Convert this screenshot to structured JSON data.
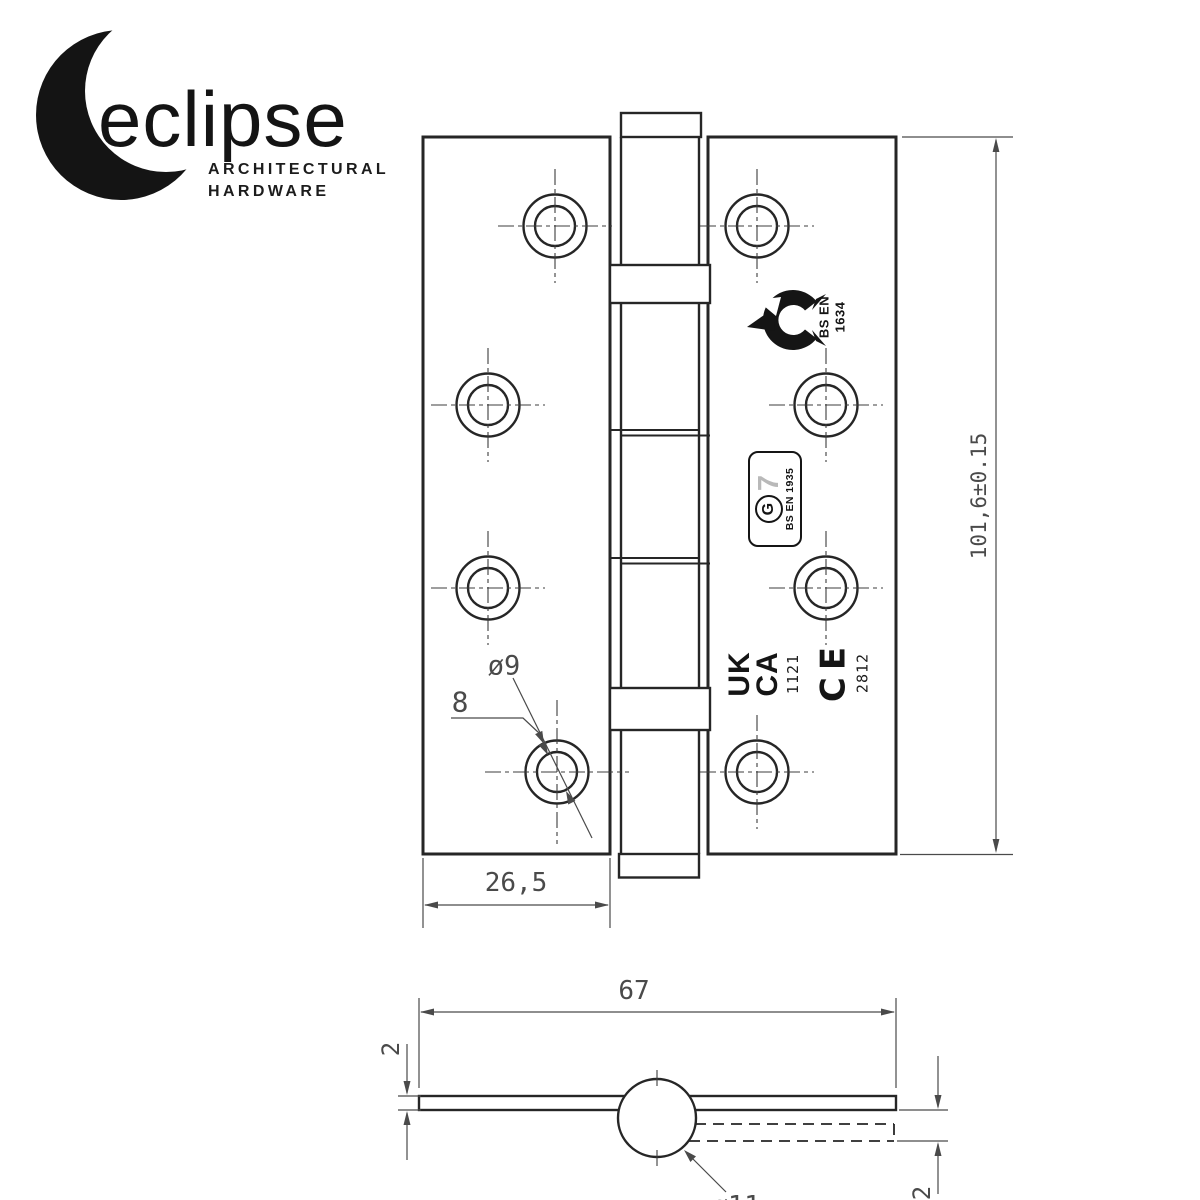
{
  "brand": {
    "name": "eclipse",
    "tagline_line1": "ARCHITECTURAL",
    "tagline_line2": "HARDWARE"
  },
  "dimensions": {
    "plate_height": "101,6±0.15",
    "leaf_width": "26,5",
    "open_width": "67",
    "screw_hole_diameter": "ø9",
    "countersink_ref": "8",
    "knuckle_diameter": "ø11",
    "leaf_thickness_left": "2",
    "leaf_thickness_right": "2"
  },
  "certifications": {
    "fire": {
      "line1": "BS EN",
      "line2": "1634"
    },
    "grade": {
      "letter": "G",
      "number": "7",
      "standard": "BS EN 1935"
    },
    "ukca": {
      "line1": "UK",
      "line2": "CA",
      "notified_body": "1121"
    },
    "ce": {
      "mark": "CE",
      "notified_body": "2812"
    }
  },
  "icons": {
    "logo": "eclipse-crescent-icon",
    "fire": "fire-flame-icon"
  },
  "colors": {
    "line": "#262626",
    "dim_text": "#4a4a4a",
    "stamp": "#151515",
    "grade_number_gray": "#b9b9b9"
  }
}
